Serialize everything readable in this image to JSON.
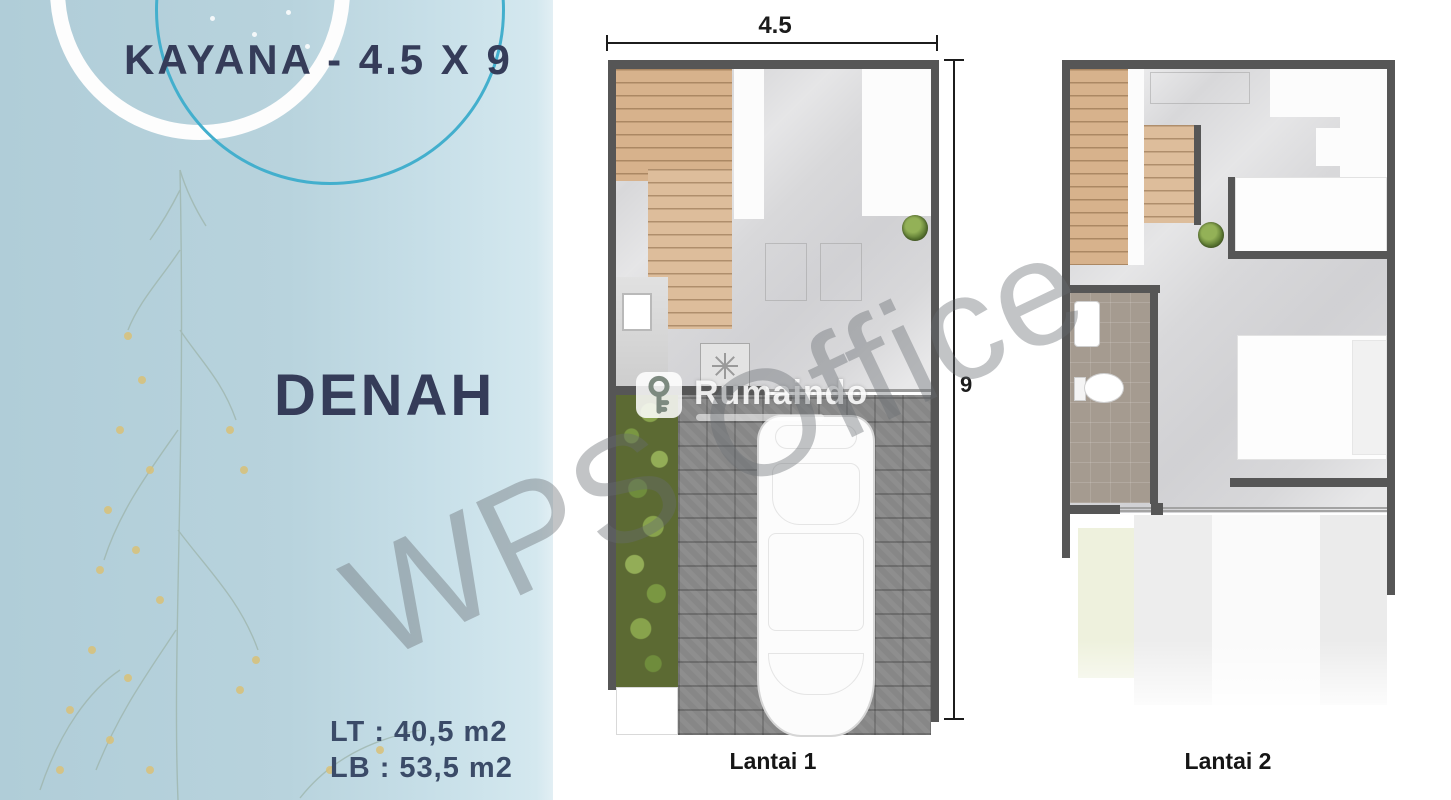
{
  "left_panel": {
    "title": "KAYANA - 4.5 X 9",
    "heading": "DENAH",
    "land_area": "LT : 40,5 m2",
    "building_area": "LB : 53,5 m2"
  },
  "floorplan1": {
    "label": "Lantai 1",
    "width_dim": "4.5",
    "height_dim": "9"
  },
  "floorplan2": {
    "label": "Lantai 2"
  },
  "watermarks": {
    "wps": "WPS Office",
    "brand": "Rumaindo"
  },
  "colors": {
    "panel_blue": "#b8d3dd",
    "title_navy": "#353c59",
    "accent_teal": "#43afcd",
    "wall_gray": "#565656",
    "stair_wood": "#d7b28c",
    "floor_marble": "#d8d8da",
    "garden_green": "#5c6a33",
    "driveway_gray": "#878787",
    "bathroom_taupe": "#a59b90"
  }
}
